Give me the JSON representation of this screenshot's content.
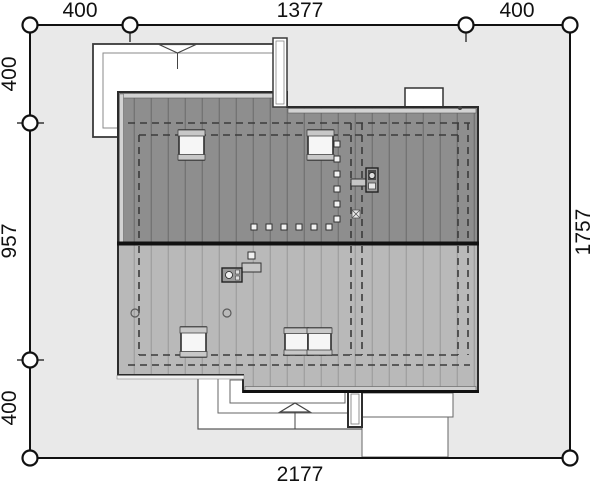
{
  "plan": {
    "dims": {
      "top_left": "400",
      "top_middle": "1377",
      "top_right": "400",
      "left_upper": "400",
      "left_middle": "957",
      "left_lower": "400",
      "right_full": "1757",
      "bottom_full": "2177"
    },
    "colors": {
      "background": "#ffffff",
      "plot_fill": "#e9e9e9",
      "roof_upper_slope": "#8e8e8e",
      "roof_lower_slope": "#b9b9b9",
      "roof_seam_upper": "#747474",
      "roof_seam_lower": "#a1a1a1",
      "fascia": "#d2d2d2",
      "outline": "#1a1a1a",
      "dashed_wall_line": "#3b3b3b"
    },
    "symbols": {
      "entrance_arrow_north": "triangle-down",
      "entrance_arrow_south": "triangle-up",
      "roof_windows_upper_slope": 2,
      "roof_windows_lower_slope": 3,
      "chimney_north": 1,
      "chimney_south": 1,
      "roof_vents": 2,
      "snow_guard_row_squares": 6,
      "snow_guard_column_squares": 6,
      "dimension_markers": "circles"
    }
  }
}
